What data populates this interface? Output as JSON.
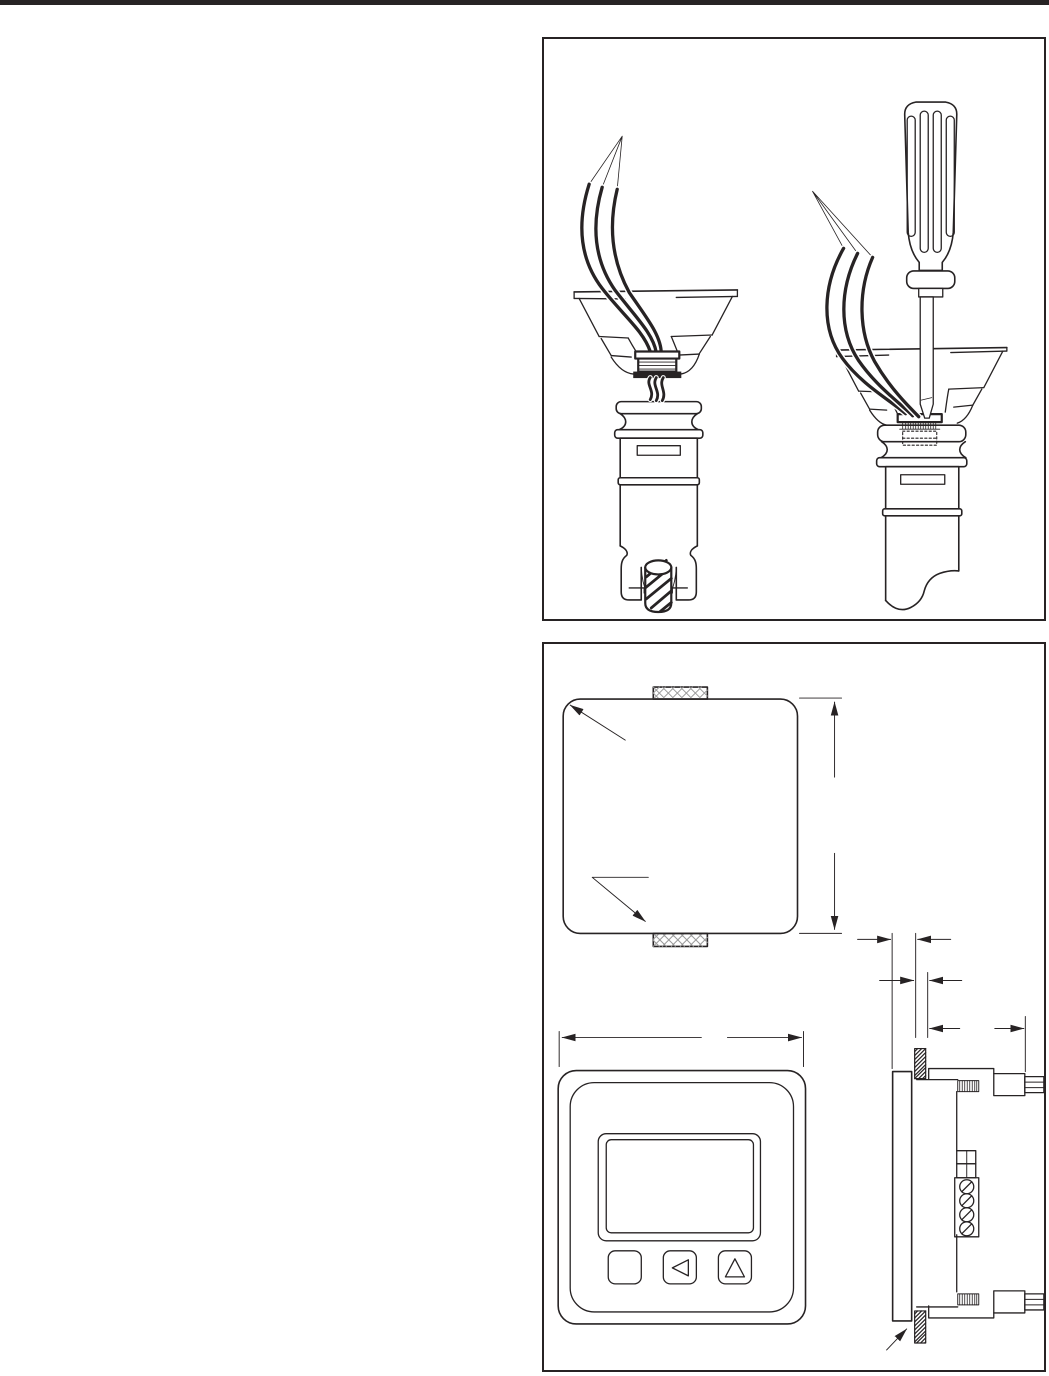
{
  "page": {
    "background_color": "#ffffff",
    "ink_color": "#272324",
    "hatch_color": "#9a9a9a",
    "top_rule_color": "#272324"
  },
  "figures": {
    "wiring": {
      "id": "probe-wiring-figure",
      "description": "Line illustration of two probe assemblies: stripped wire leads are pulled up through a mounting cup and ribbed cable gland above a cylindrical probe with an anchor screw; in the second assembly a screwdriver presses the gland down into the probe body.",
      "elements": [
        "stripped-wire-leads",
        "wire-bundle",
        "mounting-cup",
        "cable-gland",
        "probe-body",
        "anchor-screw",
        "screwdriver"
      ]
    },
    "dimensions": {
      "id": "mounting-dimension-figure",
      "description": "Outline dimension drawing of a panel-mounted display unit: rear view with two cross-hatched mounting tabs and leader callouts, front view with display window and three buttons, and side view through the panel cut-out with clamp screws and a four-screw terminal block; dimension lines are drawn without printed values.",
      "views": [
        "rear-view",
        "front-view",
        "side-view"
      ],
      "front_view_buttons": [
        "blank-button",
        "left-triangle-button",
        "up-triangle-button"
      ]
    }
  }
}
